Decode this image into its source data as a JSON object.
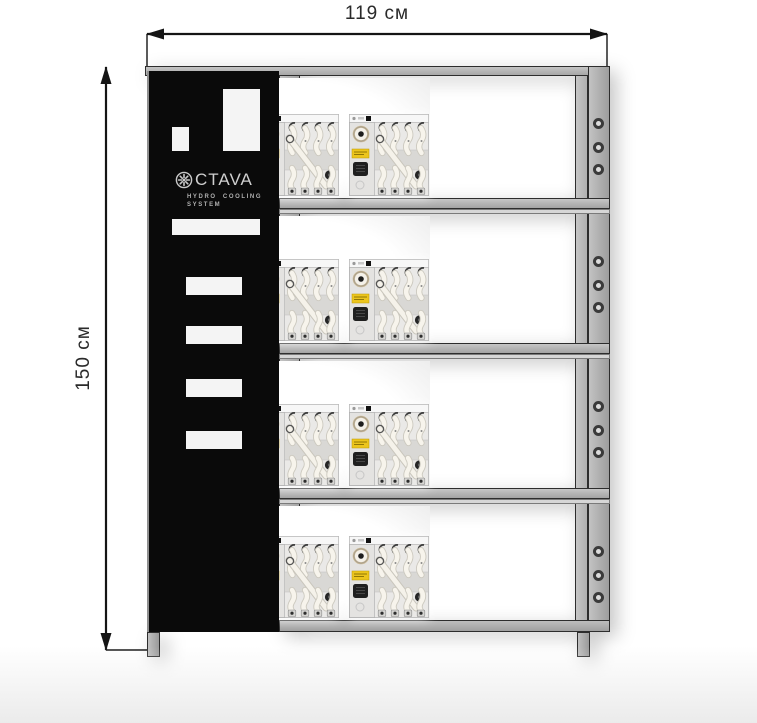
{
  "dimensions": {
    "width_label": "119 см",
    "height_label": "150 см"
  },
  "brand_panel": {
    "logo_text": "CTAVA",
    "brand_name": "OCTAVA",
    "subtitle_line1": "HYDRO COOLING",
    "subtitle_line2": "SYSTEM"
  },
  "rack": {
    "shelf_count": 4,
    "devices_per_shelf": 3,
    "total_devices": 12,
    "vent_slot_count": 4,
    "holes_per_section": 3
  },
  "colors": {
    "frame": "#b5b5b5",
    "frame_outline": "#2d2d2d",
    "panel_bg": "#0a0a0a",
    "logo_text": "#cfcfcf",
    "device_label_yellow": "#ecc51d",
    "dimension_text": "#2a2a2a"
  }
}
